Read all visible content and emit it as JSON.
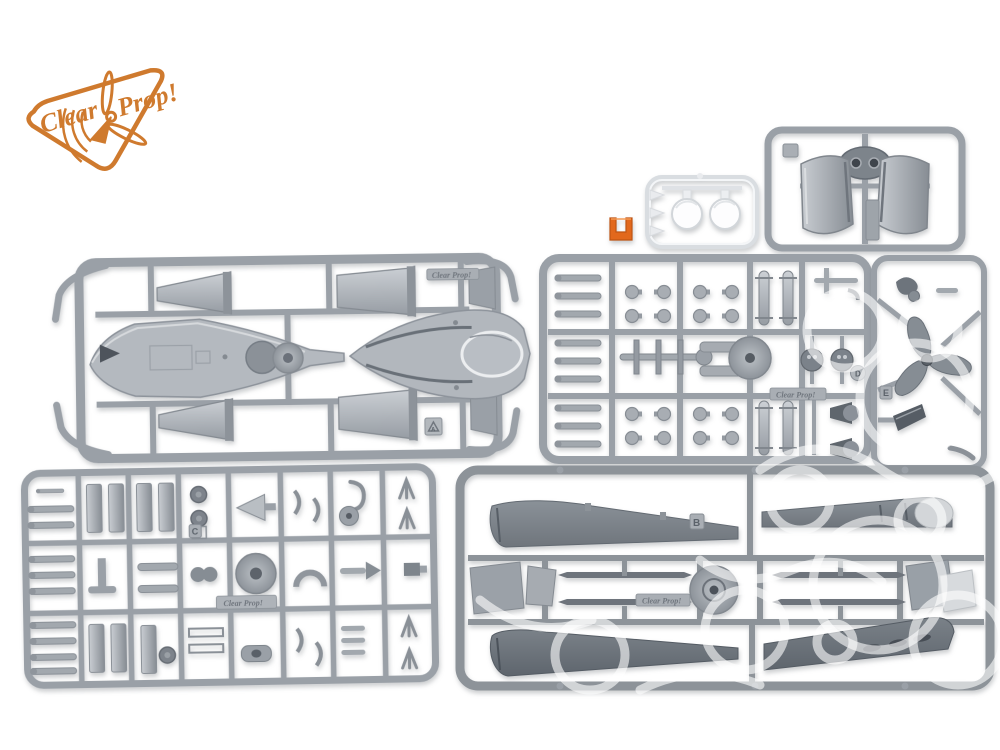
{
  "photo": {
    "subject": "plastic scale model kit sprues",
    "background": "#ffffff"
  },
  "branding": {
    "logo_text_1": "Clear",
    "logo_text_2": "Prop!",
    "logo_color": "#cf7a2e",
    "molded_text": "Clear Prop!"
  },
  "colors": {
    "plastic_gray": "#a6abb1",
    "plastic_dark": "#7e858c",
    "clear_plastic": "#eef1f4",
    "orange_part": "#e2681c"
  },
  "sprues": {
    "a": {
      "tag": "A",
      "contents": "fuselage halves, engine cowlings, hub disc"
    },
    "b": {
      "tag": "B",
      "contents": "wing halves, spars, hub disc"
    },
    "c": {
      "tag": "C",
      "contents": "small detail parts grid"
    },
    "d": {
      "tag": "D",
      "contents": "bombs, wheels, small detail parts"
    },
    "e": {
      "tag": "E",
      "contents": "three-blade propeller, spinner"
    },
    "f": {
      "contents": "engine cowling shells"
    },
    "clear": {
      "contents": "two clear canopy parts"
    },
    "orange": {
      "contents": "orange bracket part"
    }
  }
}
